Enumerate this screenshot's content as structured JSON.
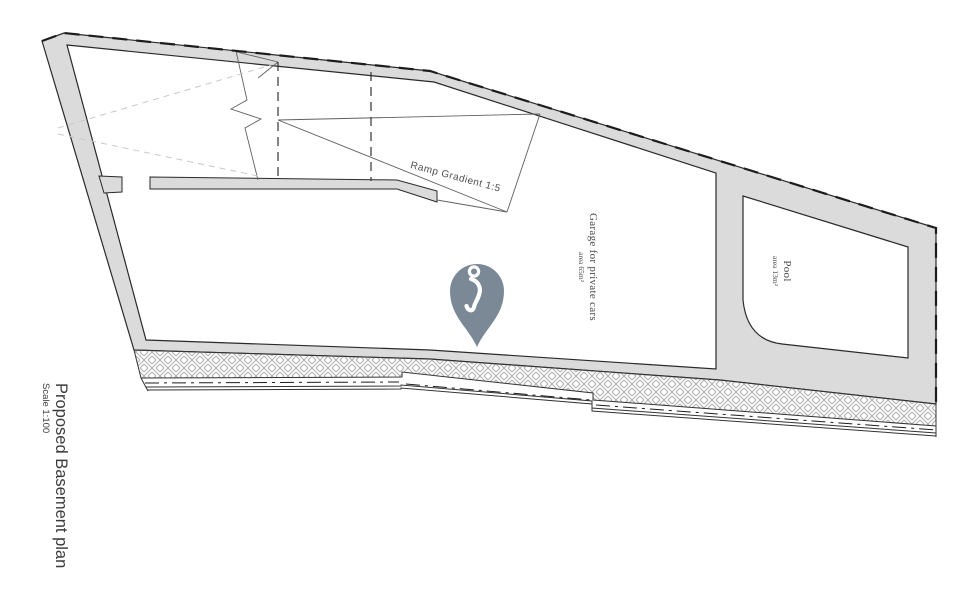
{
  "title": {
    "main": "Proposed Basement plan",
    "scale": "Scale 1:100"
  },
  "labels": {
    "ramp": "Ramp Gradient 1:5",
    "garage": {
      "name": "Garage for private cars",
      "area": "area 65m²"
    },
    "pool": {
      "name": "Pool",
      "area": "area 13m²"
    }
  },
  "marker": {
    "icon": "location-pin",
    "color": "#7b8997"
  },
  "colors": {
    "wall-fill": "#dbdbdb",
    "outline": "#2a2a2a",
    "hatch-line": "#b0b0b0",
    "dashed-light": "#c8c8c8",
    "thin-line": "#606060",
    "text": "#3b3b3b",
    "pin": "#7b8997"
  }
}
